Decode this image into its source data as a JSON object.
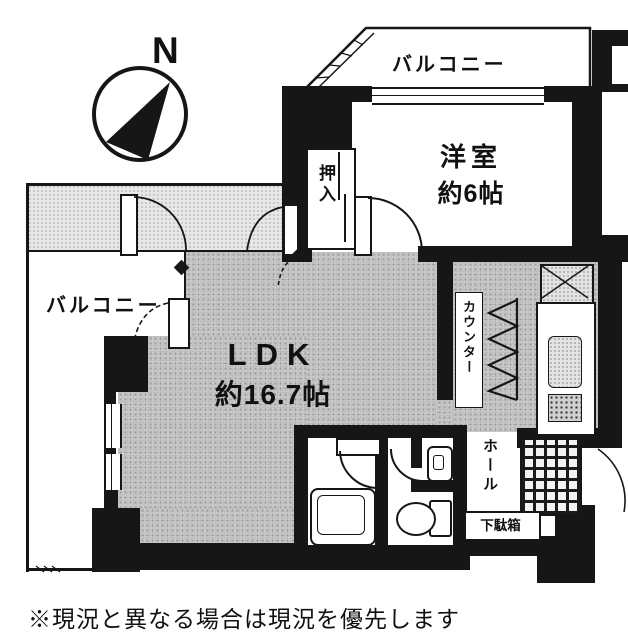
{
  "compass": {
    "north_label": "N"
  },
  "labels": {
    "balcony_top": "バルコニー",
    "balcony_left": "バルコニー",
    "western_room_name": "洋室",
    "western_room_size": "約6帖",
    "closet": "押入",
    "ldk_name": "LDK",
    "ldk_size": "約16.7帖",
    "counter": "カウンター",
    "hall": "ホール",
    "shoe_cabinet": "下駄箱"
  },
  "caption": "※現況と異なる場合は現況を優先します",
  "colors": {
    "wall": "#161616",
    "floor_gray": "#c9c9c9",
    "floor_light": "#e7e7e7",
    "paper": "#ffffff"
  }
}
